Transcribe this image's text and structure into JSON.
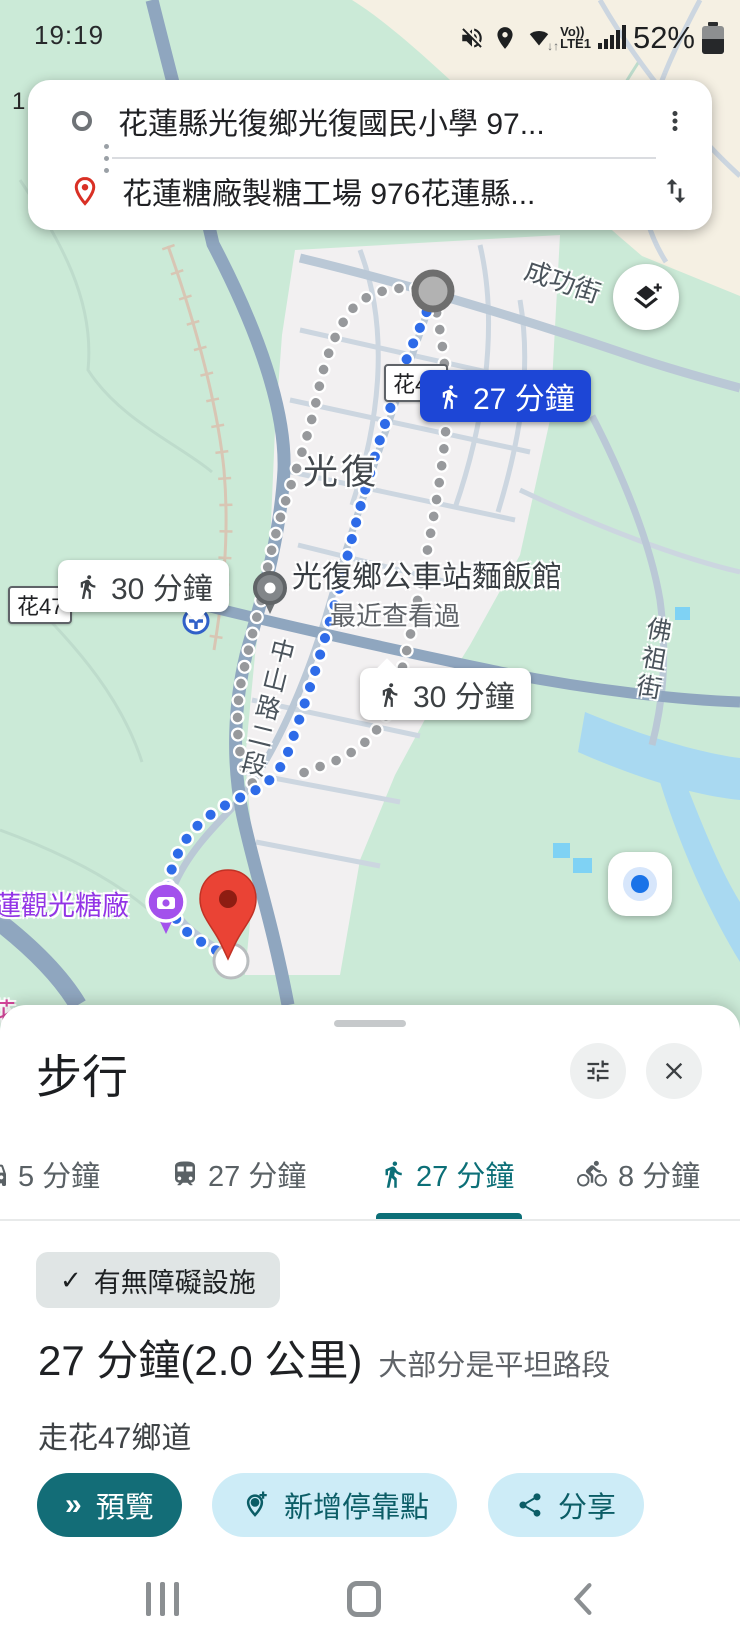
{
  "status_bar": {
    "time": "19:19",
    "network_top": "Vo))",
    "network_bottom": "LTE1",
    "battery_percent": "52%"
  },
  "directions_card": {
    "origin": "花蓮縣光復鄉光復國民小學 97...",
    "destination": "花蓮糖廠製糖工場 976花蓮縣..."
  },
  "map": {
    "stray_label": "1",
    "road_badge_left": "花47",
    "road_badge_mid": "花47",
    "road_shield": "11甲",
    "street_chenggong": "成功街",
    "town": "光復",
    "street_zhongshan": "中山路二段",
    "street_fozu": "佛祖街",
    "poi_name": "光復鄉公車站麵飯館",
    "poi_sub": "最近查看過",
    "sugar_factory": "蓮觀光糖廠",
    "partial_label": "花",
    "eta_primary": "27 分鐘",
    "eta_alt_left": "30 分鐘",
    "eta_alt_right": "30 分鐘"
  },
  "bottom_sheet": {
    "title": "步行",
    "tabs": [
      {
        "mode": "car",
        "label": "5 分鐘"
      },
      {
        "mode": "transit",
        "label": "27 分鐘"
      },
      {
        "mode": "walk",
        "label": "27 分鐘",
        "selected": true
      },
      {
        "mode": "bike",
        "label": "8 分鐘"
      }
    ],
    "chip": {
      "check": "✓",
      "label": "有無障礙設施"
    },
    "summary": {
      "duration_distance": "27 分鐘(2.0 公里)",
      "note": "大部分是平坦路段"
    },
    "via": "走花47鄉道",
    "actions": {
      "preview": "預覽",
      "preview_icon": "»",
      "add_stop": "新增停靠點",
      "share": "分享"
    }
  },
  "colors": {
    "teal": "#136d77",
    "light_teal_button": "#cdecf7",
    "selected_tab": "#0c6f77",
    "route_badge_blue": "#1d46d6",
    "route_dot_blue": "#2e6be8",
    "alt_dot_grey": "#97999c",
    "destination_red": "#ea4335",
    "poi_purple": "#9334e6"
  }
}
